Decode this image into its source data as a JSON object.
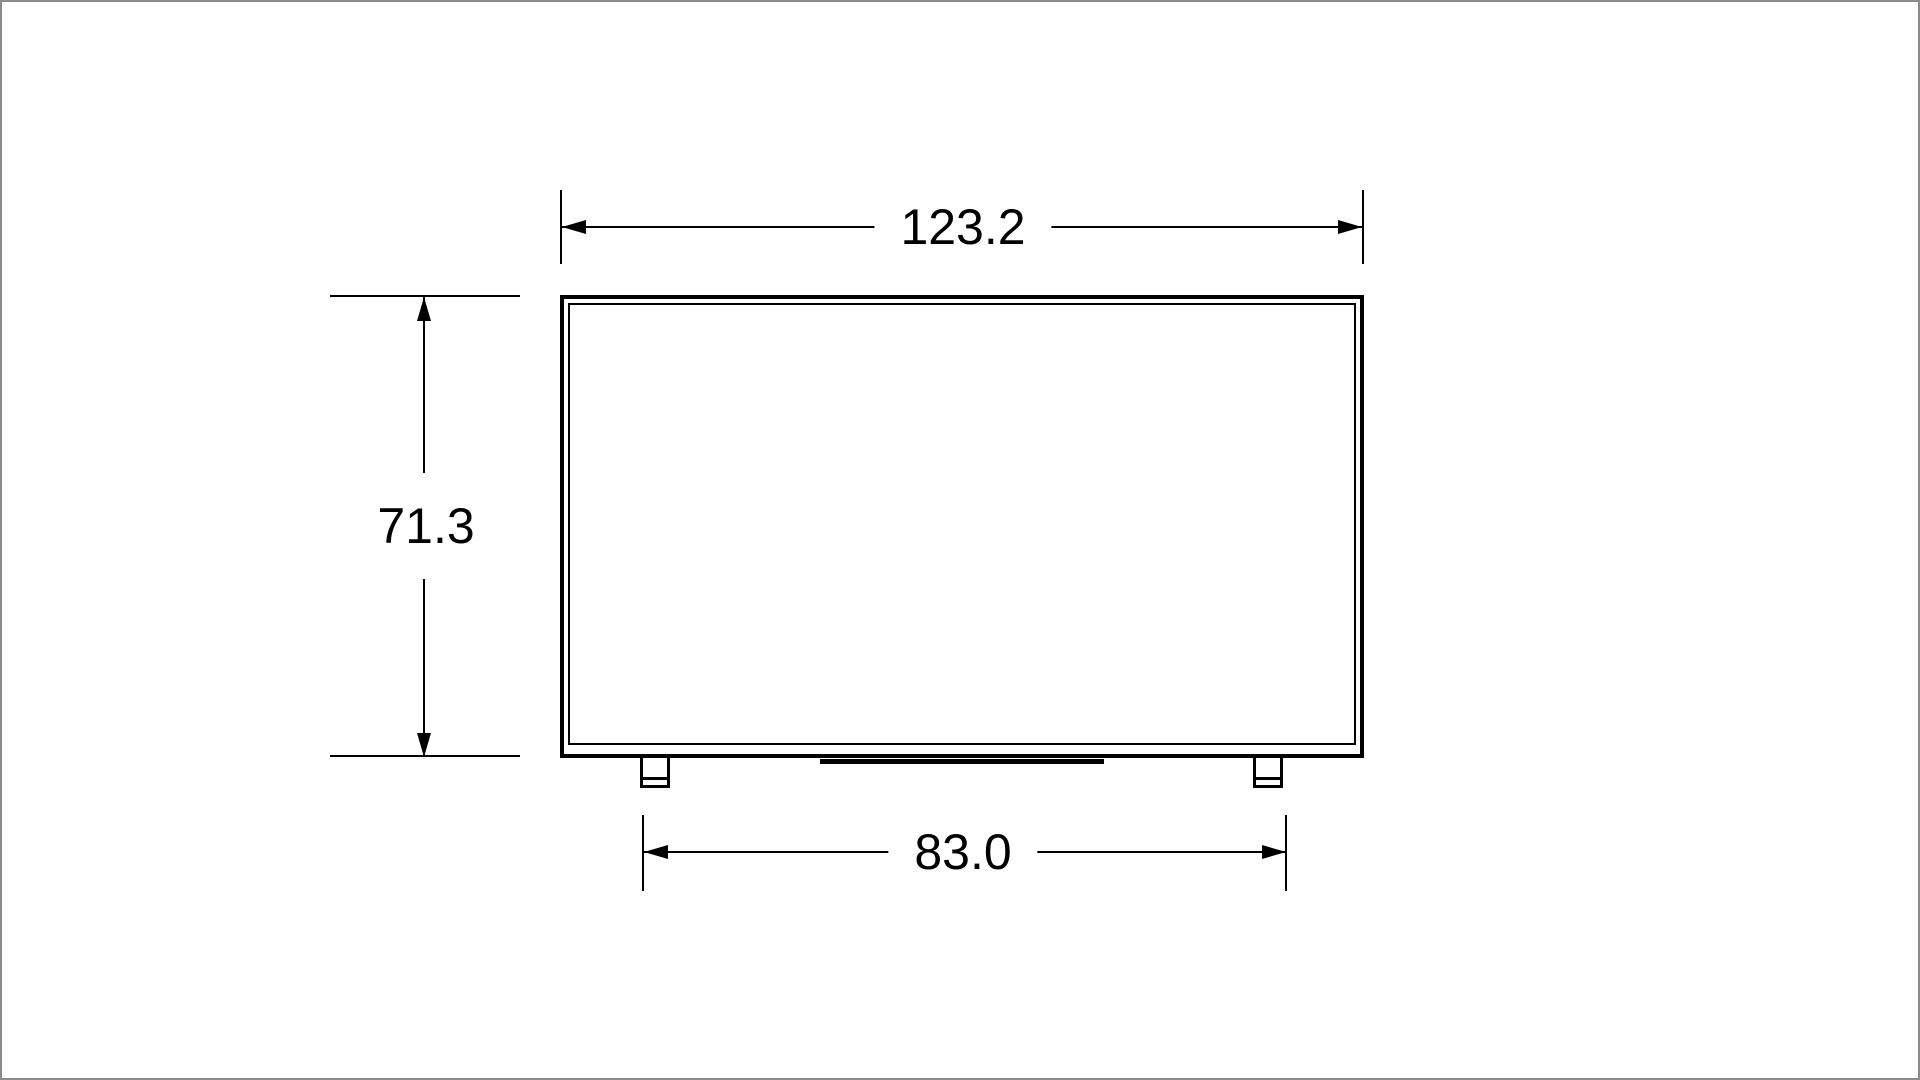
{
  "diagram": {
    "type": "dimension-drawing",
    "subject": "tv-front-view-outline",
    "dimensions": {
      "width": {
        "value": "123.2"
      },
      "height": {
        "value": "71.3"
      },
      "stand_width": {
        "value": "83.0"
      }
    },
    "colors": {
      "line": "#000000",
      "background": "#ffffff",
      "canvas_border": "#8a8a8a"
    }
  }
}
